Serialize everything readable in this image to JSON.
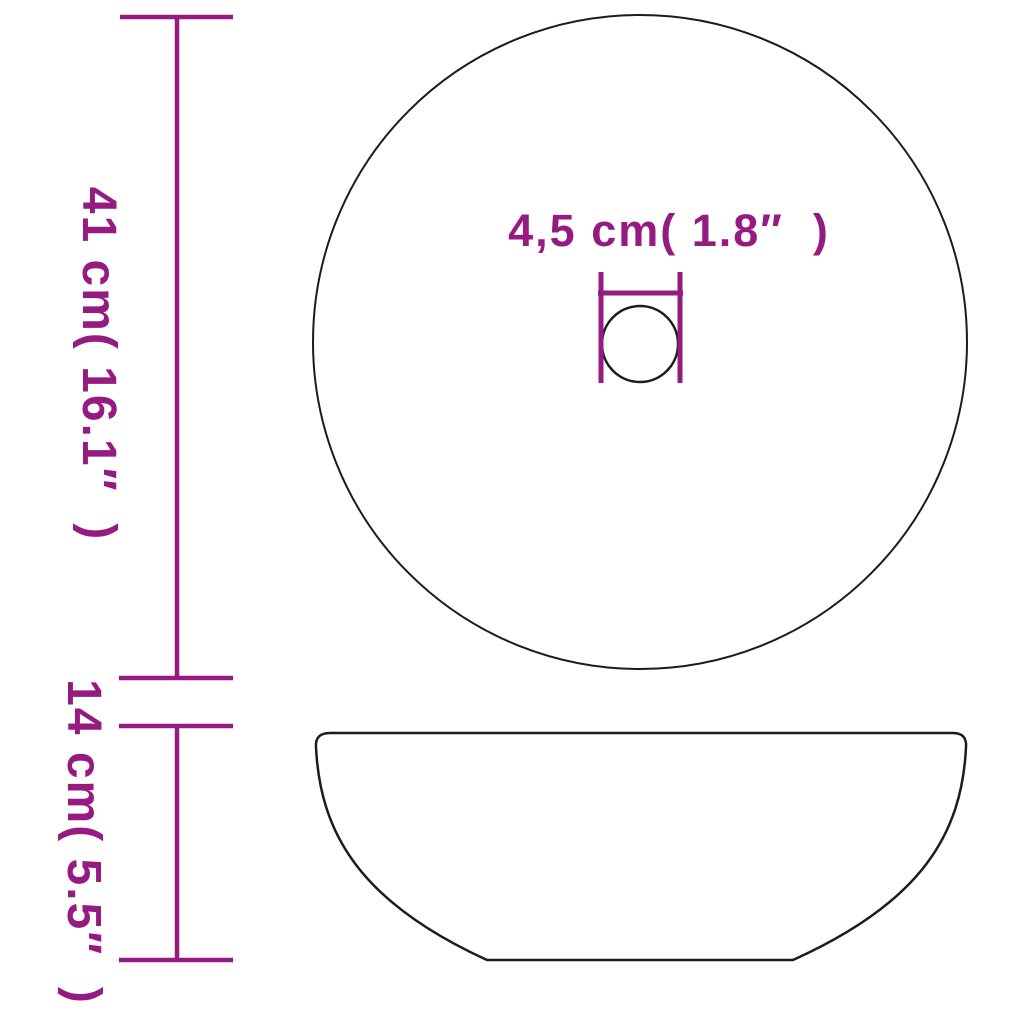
{
  "page": {
    "background": "#FFFFFF"
  },
  "diagram": {
    "subject": "round-countertop-washbasin-dimensions",
    "colors": {
      "dimension": "#951B81",
      "outline": "#1C1C1C"
    },
    "views": [
      {
        "id": "top-view",
        "shape": "circle-with-drain-hole"
      },
      {
        "id": "side-view",
        "shape": "bowl-profile"
      }
    ],
    "dimensions": [
      {
        "id": "basin-diameter",
        "label": "41 cm( 16.1″  )",
        "value_cm": "41",
        "value_in": "16.1",
        "orientation": "vertical"
      },
      {
        "id": "basin-height",
        "label": "14 cm( 5.5″  )",
        "value_cm": "14",
        "value_in": "5.5",
        "orientation": "vertical"
      },
      {
        "id": "drain-diameter",
        "label": "4,5 cm( 1.8″  )",
        "value_cm": "4,5",
        "value_in": "1.8",
        "orientation": "horizontal"
      }
    ]
  }
}
